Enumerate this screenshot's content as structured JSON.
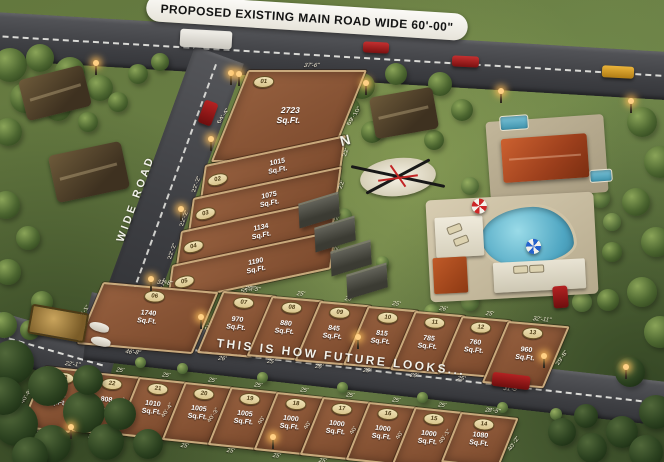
{
  "banner": {
    "text": "PROPOSED EXISTING MAIN ROAD WIDE 60'-00\""
  },
  "roads": {
    "side_road_label": "WIDE ROAD",
    "slogan": "THIS IS HOW FUTURE LOOKS..."
  },
  "compass": {
    "north_label": "N"
  },
  "plot_unit": "Sq.Ft.",
  "colors": {
    "plot_soil": "#8a5636",
    "plot_wall": "#c9a97c",
    "badge_bg": "#e9dcb0",
    "road": "#46474b",
    "banner_bg": "#f5f3ee",
    "grass": "#6d8148"
  },
  "plots": [
    {
      "no": "01",
      "area": "2723",
      "dims": {
        "top": "37'-6\"",
        "left": "64'-4\"",
        "right": "69'-10\"",
        "bottom": "44'-10\""
      }
    },
    {
      "no": "02",
      "area": "1015",
      "dims": {
        "left": "22'-2\"",
        "right": "22'",
        "bottom": "47'-6\""
      }
    },
    {
      "no": "03",
      "area": "1075",
      "dims": {
        "left": "22'-2\"",
        "right": "22'",
        "bottom": "50'-3\""
      }
    },
    {
      "no": "04",
      "area": "1134",
      "dims": {
        "left": "22'-2\"",
        "right": "22'",
        "bottom": "52'-11\""
      }
    },
    {
      "no": "05",
      "area": "1190",
      "dims": {
        "left": "22'-2\"",
        "right": "22'",
        "bottom": "55'-7\""
      }
    },
    {
      "no": "06",
      "area": "1740",
      "dims": {
        "top": "32'-8\"",
        "left": "45'-1\"",
        "right": "41'-1\"",
        "bottom": "46'-8\""
      }
    },
    {
      "no": "07",
      "area": "970",
      "dims": {
        "top": "25'-5\"",
        "right": "36'",
        "bottom": "26'"
      }
    },
    {
      "no": "08",
      "area": "880",
      "dims": {
        "top": "25'",
        "right": "35'-7\"",
        "bottom": "25'"
      }
    },
    {
      "no": "09",
      "area": "845",
      "dims": {
        "top": "26'",
        "right": "32'-3\"",
        "bottom": "26'"
      }
    },
    {
      "no": "10",
      "area": "815",
      "dims": {
        "top": "25'",
        "right": "32'-1\"",
        "bottom": "25'"
      }
    },
    {
      "no": "11",
      "area": "785",
      "dims": {
        "top": "26'",
        "right": "31'",
        "bottom": "26'"
      }
    },
    {
      "no": "12",
      "area": "760",
      "dims": {
        "top": "25'",
        "right": "30'-1\"",
        "bottom": "25'"
      }
    },
    {
      "no": "13",
      "area": "960",
      "dims": {
        "top": "32'-11\"",
        "right": "29'-8\"",
        "bottom": "31'-5\""
      }
    },
    {
      "no": "23",
      "area": "1042",
      "dims": {
        "top": "22'-1\"",
        "left": "40'-8\"",
        "bottom": "29'-9\""
      }
    },
    {
      "no": "22",
      "area": "808",
      "dims": {
        "top": "25'",
        "left": "40'-5\"",
        "bottom": "30'"
      }
    },
    {
      "no": "21",
      "area": "1010",
      "dims": {
        "top": "25'",
        "left": "40'-6\"",
        "bottom": "25'"
      }
    },
    {
      "no": "20",
      "area": "1005",
      "dims": {
        "top": "25'",
        "left": "40'-4\"",
        "bottom": "25'"
      }
    },
    {
      "no": "19",
      "area": "1005",
      "dims": {
        "top": "25'",
        "left": "40'-3\"",
        "bottom": "25'"
      }
    },
    {
      "no": "18",
      "area": "1000",
      "dims": {
        "top": "25'",
        "left": "40'",
        "bottom": "25'"
      }
    },
    {
      "no": "17",
      "area": "1000",
      "dims": {
        "top": "25'",
        "left": "40'",
        "bottom": "25'"
      }
    },
    {
      "no": "16",
      "area": "1000",
      "dims": {
        "top": "25'",
        "left": "40'",
        "bottom": "25'"
      }
    },
    {
      "no": "15",
      "area": "1000",
      "dims": {
        "top": "25'",
        "left": "40'",
        "bottom": "25'"
      }
    },
    {
      "no": "14",
      "area": "1080",
      "dims": {
        "top": "28'-5\"",
        "left": "40'-1\"",
        "right": "40'-2\"",
        "bottom": "25'"
      }
    }
  ]
}
